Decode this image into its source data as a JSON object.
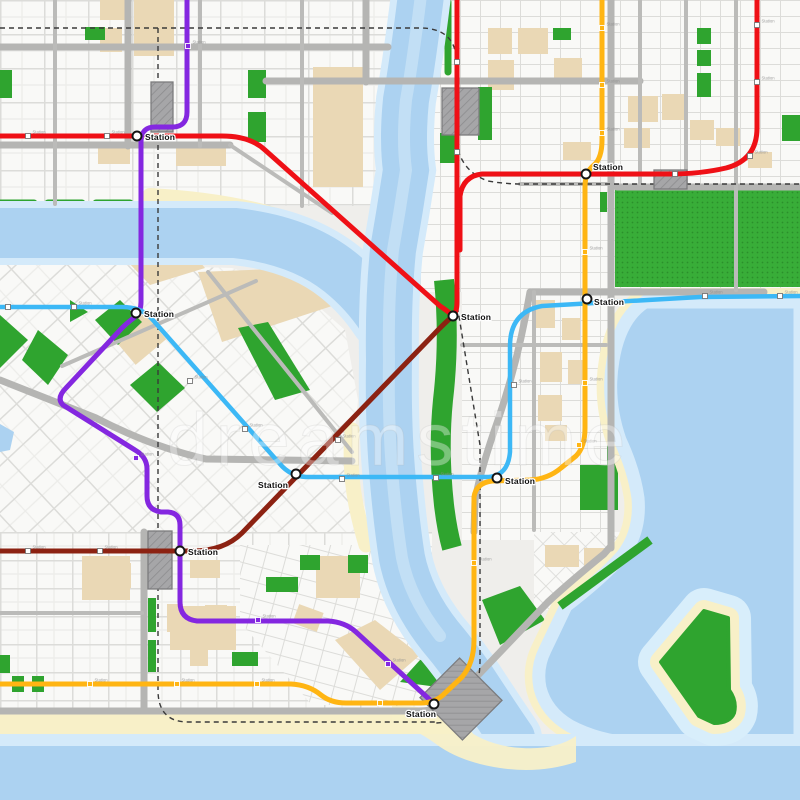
{
  "map": {
    "watermark_text": "dreamstime",
    "station_label": "Station",
    "colors": {
      "red_line": "#EF1016",
      "maroon_line": "#8C2212",
      "purple_line": "#8427E0",
      "cyan_line": "#3CB8F6",
      "orange_line": "#FFB513",
      "water_deep": "#ACD2F1",
      "water_shallow": "#D4EAFA",
      "park_green": "#2FA42F",
      "beach_sand": "#F8F0C8",
      "road_gray": "#B5B5B3",
      "building_gray": "#A6A6A8",
      "marker_white": "#FFFFFF"
    },
    "lines": [
      {
        "name": "red-line",
        "color": "#EF1016",
        "width": 5,
        "paths": [
          "M0,136 H222 Q250,136 265,150 L440,306 Q449,312 453,316",
          "M457,0 V302 Q457,312 453,316",
          "M757,0 V128 Q757,160 726,168 Q700,174 670,174 H482 Q463,176 460,196 V250"
        ]
      },
      {
        "name": "maroon-line",
        "color": "#8C2212",
        "width": 5,
        "paths": [
          "M0,551 H192 Q224,551 242,533 L438,330 Q448,320 453,316"
        ]
      },
      {
        "name": "purple-line",
        "color": "#8427E0",
        "width": 5,
        "paths": [
          "M187,0 V112 Q187,127 172,127 H155 Q141,127 141,142 V302 Q141,312 135,317 Q128,322 122,328 L66,388 Q56,398 63,405 L135,450 Q147,457 147,469 V496 Q147,510 161,512 H168 Q180,513 180,525 V602 Q180,619 197,621 H328 Q345,622 356,632 L429,699 Q432,702 434,704"
        ]
      },
      {
        "name": "cyan-line",
        "color": "#3CB8F6",
        "width": 4.5,
        "paths": [
          "M0,307 H122 Q142,307 152,319 L280,464 Q290,476 306,477 H486 Q508,477 510,452 V346 Q510,312 542,306 L700,297 L800,296"
        ]
      },
      {
        "name": "orange-line",
        "color": "#FFB513",
        "width": 5,
        "paths": [
          "M602,0 V140 Q602,158 594,165 Q585,172 585,187 V428 Q585,447 576,456 L561,468 Q548,479 530,480 L492,481 Q476,483 474,497 V640 Q474,663 462,677 L443,695 Q434,703 421,703 H346 Q331,703 321,695 Q309,685 291,684 H0"
        ]
      }
    ],
    "stations": [
      {
        "x": 137,
        "y": 136,
        "tx": 145,
        "ty": 140
      },
      {
        "x": 586,
        "y": 174,
        "tx": 593,
        "ty": 170
      },
      {
        "x": 136,
        "y": 313,
        "tx": 144,
        "ty": 317
      },
      {
        "x": 453,
        "y": 316,
        "tx": 461,
        "ty": 320
      },
      {
        "x": 296,
        "y": 474,
        "tx": 258,
        "ty": 488
      },
      {
        "x": 497,
        "y": 478,
        "tx": 505,
        "ty": 484
      },
      {
        "x": 587,
        "y": 299,
        "tx": 594,
        "ty": 305
      },
      {
        "x": 180,
        "y": 551,
        "tx": 188,
        "ty": 555
      },
      {
        "x": 434,
        "y": 704,
        "tx": 406,
        "ty": 717
      }
    ],
    "markers": {
      "white": [
        [
          28,
          136,
          1
        ],
        [
          107,
          136,
          1
        ],
        [
          457,
          62,
          0
        ],
        [
          457,
          152,
          0
        ],
        [
          675,
          174,
          0
        ],
        [
          757,
          25,
          1
        ],
        [
          757,
          82,
          1
        ],
        [
          750,
          156,
          1
        ],
        [
          8,
          307,
          0
        ],
        [
          74,
          307,
          1
        ],
        [
          190,
          381,
          1
        ],
        [
          245,
          429,
          1
        ],
        [
          342,
          479,
          1
        ],
        [
          436,
          478,
          1
        ],
        [
          514,
          385,
          1
        ],
        [
          705,
          296,
          1
        ],
        [
          780,
          296,
          1
        ],
        [
          28,
          551,
          1
        ],
        [
          100,
          551,
          1
        ],
        [
          338,
          440,
          1
        ]
      ],
      "orange": [
        [
          602,
          28,
          1
        ],
        [
          602,
          85,
          1
        ],
        [
          602,
          133,
          1
        ],
        [
          585,
          252,
          1
        ],
        [
          585,
          383,
          1
        ],
        [
          579,
          445,
          1
        ],
        [
          474,
          563,
          1
        ],
        [
          90,
          684,
          1
        ],
        [
          177,
          684,
          1
        ],
        [
          257,
          684,
          1
        ],
        [
          380,
          703,
          0
        ]
      ],
      "purple": [
        [
          188,
          46,
          1
        ],
        [
          136,
          458,
          1
        ],
        [
          258,
          620,
          1
        ],
        [
          388,
          664,
          1
        ]
      ]
    },
    "buildings": [
      {
        "x": 151,
        "y": 82,
        "w": 22,
        "h": 50,
        "r": 0
      },
      {
        "x": 442,
        "y": 88,
        "w": 37,
        "h": 47,
        "r": 0
      },
      {
        "x": 654,
        "y": 170,
        "w": 33,
        "h": 19,
        "r": 0
      },
      {
        "x": 148,
        "y": 531,
        "w": 24,
        "h": 58,
        "r": 0
      },
      {
        "x": 431,
        "y": 671,
        "w": 60,
        "h": 56,
        "r": 45
      }
    ]
  }
}
